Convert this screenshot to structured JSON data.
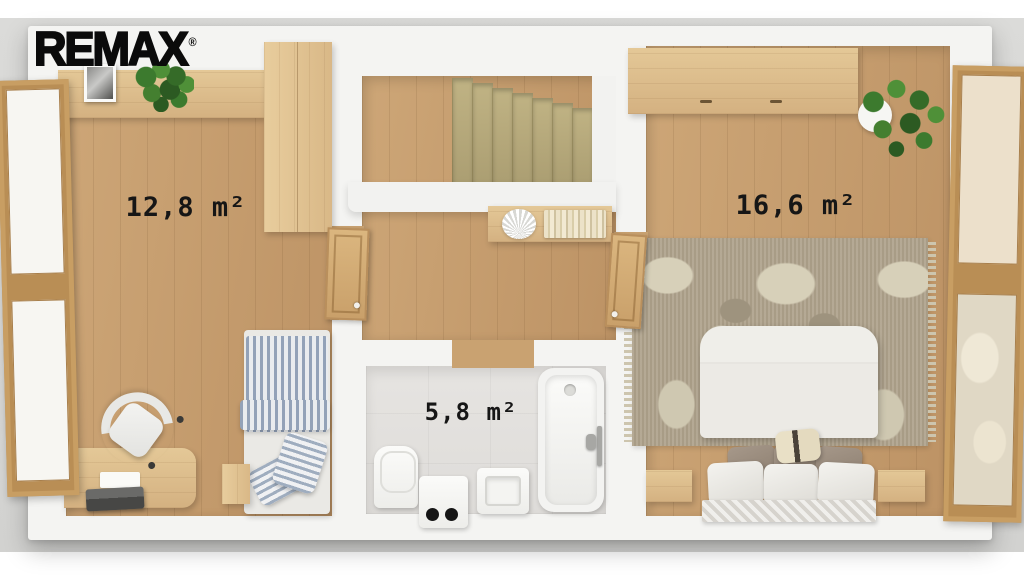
{
  "brand": {
    "logo_text": "REMAX",
    "registered_mark": "®"
  },
  "rooms": [
    {
      "name": "bedroom-left",
      "area_label": "12,8 m²"
    },
    {
      "name": "bathroom",
      "area_label": "5,8 m²"
    },
    {
      "name": "bedroom-right",
      "area_label": "16,6 m²"
    }
  ],
  "palette": {
    "ground": "#d6d6d4",
    "wall": "#f4f4f2",
    "wood_floor": "#c59d6e",
    "wood_furniture": "#ddbd8d",
    "stair_tread": "#b5a87a",
    "bathroom_tile": "#e2e0dd",
    "rug_base": "#b0a48e",
    "rug_pattern": "#d7d0b9",
    "bedding_blue": "#93a2b8",
    "plant_green": "#3f7a31",
    "label_text": "#161616",
    "logo_black": "#0b0b0b"
  }
}
